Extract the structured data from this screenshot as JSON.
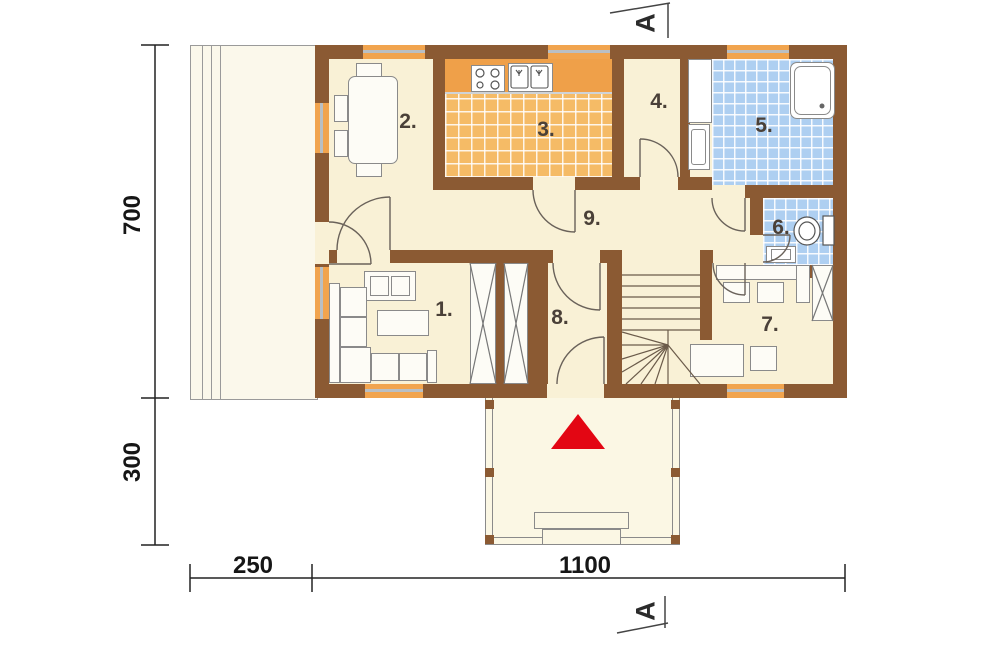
{
  "section": {
    "letter": "A"
  },
  "rooms": [
    {
      "label": "1."
    },
    {
      "label": "2."
    },
    {
      "label": "3."
    },
    {
      "label": "4."
    },
    {
      "label": "5."
    },
    {
      "label": "6."
    },
    {
      "label": "7."
    },
    {
      "label": "8."
    },
    {
      "label": "9."
    }
  ],
  "dimensions": {
    "left_upper": "700",
    "left_lower": "300",
    "bottom_left": "250",
    "bottom_right": "1100"
  },
  "colors": {
    "wall": "#8B5A33",
    "floor": "#F9F1D6",
    "terrace": "#FBF8EB",
    "kitchen_tile": "#F5BB66",
    "kitchen_counter": "#EFA049",
    "bath_tile": "#AECFF1",
    "window": "#F1A44E",
    "window_glass": "#B9BFC4",
    "entrance_arrow": "#E30613"
  }
}
